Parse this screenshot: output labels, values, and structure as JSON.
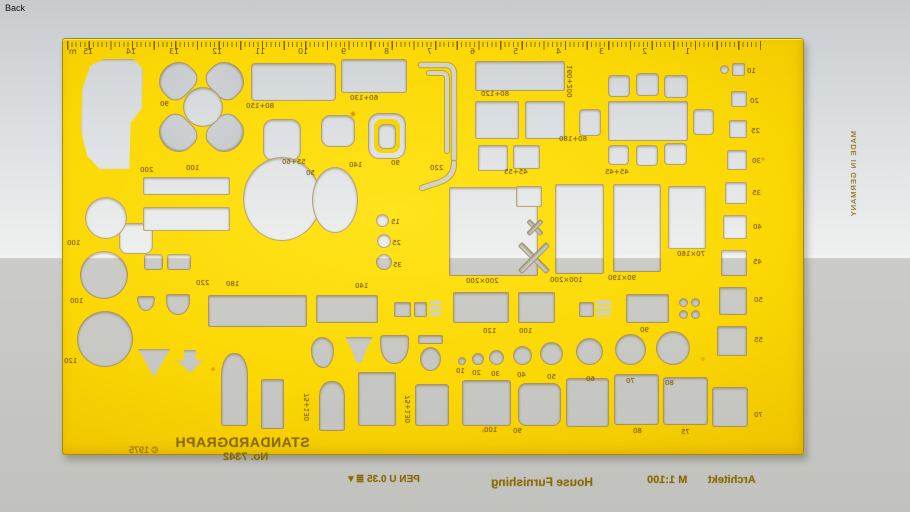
{
  "page": {
    "back_label": "Back"
  },
  "stencil": {
    "brand": "STANDARDGRAPH",
    "model": "No. 7342",
    "copyright": "© 1975",
    "pen": "PEN U 0.35 ≣▼",
    "series": "House Furnishing",
    "profession": "Architekt",
    "scale_label": "M 1:100",
    "made_in": "MADE IN GERMANY",
    "ruler": {
      "unit": "m",
      "numbers": [
        "15",
        "14",
        "13",
        "12",
        "11",
        "10",
        "9",
        "8",
        "7",
        "6",
        "5",
        "4",
        "3",
        "2",
        "1"
      ]
    },
    "labels": [
      {
        "t": "90",
        "x": 159,
        "y": 100
      },
      {
        "t": "80+150",
        "x": 245,
        "y": 102
      },
      {
        "t": "55+60",
        "x": 281,
        "y": 158
      },
      {
        "t": "50",
        "x": 305,
        "y": 169
      },
      {
        "t": "60+130",
        "x": 349,
        "y": 94
      },
      {
        "t": "90",
        "x": 390,
        "y": 159
      },
      {
        "t": "140",
        "x": 348,
        "y": 161
      },
      {
        "t": "220",
        "x": 429,
        "y": 164
      },
      {
        "t": "80+120",
        "x": 480,
        "y": 90
      },
      {
        "t": "45+55",
        "x": 503,
        "y": 168
      },
      {
        "t": "160+200",
        "x": 566,
        "y": 64,
        "v": 1
      },
      {
        "t": "80+180",
        "x": 558,
        "y": 135
      },
      {
        "t": "45+45",
        "x": 604,
        "y": 168
      },
      {
        "t": "200",
        "x": 139,
        "y": 166
      },
      {
        "t": "100",
        "x": 185,
        "y": 164
      },
      {
        "t": "100",
        "x": 66,
        "y": 239
      },
      {
        "t": "100",
        "x": 69,
        "y": 297
      },
      {
        "t": "120",
        "x": 63,
        "y": 357
      },
      {
        "t": "220",
        "x": 195,
        "y": 279
      },
      {
        "t": "180",
        "x": 225,
        "y": 280
      },
      {
        "t": "140",
        "x": 354,
        "y": 282
      },
      {
        "t": "15",
        "x": 390,
        "y": 218
      },
      {
        "t": "25",
        "x": 391,
        "y": 239
      },
      {
        "t": "35",
        "x": 392,
        "y": 261
      },
      {
        "t": "200×200",
        "x": 465,
        "y": 277
      },
      {
        "t": "100×200",
        "x": 549,
        "y": 276
      },
      {
        "t": "90×190",
        "x": 607,
        "y": 274
      },
      {
        "t": "70×160",
        "x": 676,
        "y": 250
      },
      {
        "t": "120",
        "x": 482,
        "y": 327
      },
      {
        "t": "100",
        "x": 518,
        "y": 327
      },
      {
        "t": "90",
        "x": 639,
        "y": 326
      },
      {
        "t": "10",
        "x": 455,
        "y": 367
      },
      {
        "t": "20",
        "x": 471,
        "y": 369
      },
      {
        "t": "30",
        "x": 490,
        "y": 370
      },
      {
        "t": "40",
        "x": 516,
        "y": 371
      },
      {
        "t": "50",
        "x": 546,
        "y": 373
      },
      {
        "t": "60",
        "x": 585,
        "y": 375
      },
      {
        "t": "70",
        "x": 625,
        "y": 377
      },
      {
        "t": "80",
        "x": 664,
        "y": 379
      },
      {
        "t": "75+130",
        "x": 303,
        "y": 392,
        "v": 1
      },
      {
        "t": "75+130",
        "x": 404,
        "y": 394,
        "v": 1
      },
      {
        "t": "100",
        "x": 483,
        "y": 426
      },
      {
        "t": "90",
        "x": 512,
        "y": 427
      },
      {
        "t": "80",
        "x": 632,
        "y": 427
      },
      {
        "t": "75",
        "x": 680,
        "y": 428
      },
      {
        "t": "70",
        "x": 753,
        "y": 411
      },
      {
        "t": "10",
        "x": 746,
        "y": 67
      },
      {
        "t": "20",
        "x": 749,
        "y": 97
      },
      {
        "t": "25",
        "x": 750,
        "y": 127
      },
      {
        "t": "30",
        "x": 751,
        "y": 157
      },
      {
        "t": "35",
        "x": 751,
        "y": 189
      },
      {
        "t": "40",
        "x": 752,
        "y": 223
      },
      {
        "t": "45",
        "x": 752,
        "y": 258
      },
      {
        "t": "50",
        "x": 753,
        "y": 296
      },
      {
        "t": "55",
        "x": 753,
        "y": 336
      }
    ]
  },
  "colors": {
    "template_yellow": "#f8d405",
    "engraving": "#7a5c04",
    "cutout_gray": "#d3d6d5",
    "sky": "#dde0e0",
    "ground": "#c5c5c1"
  }
}
